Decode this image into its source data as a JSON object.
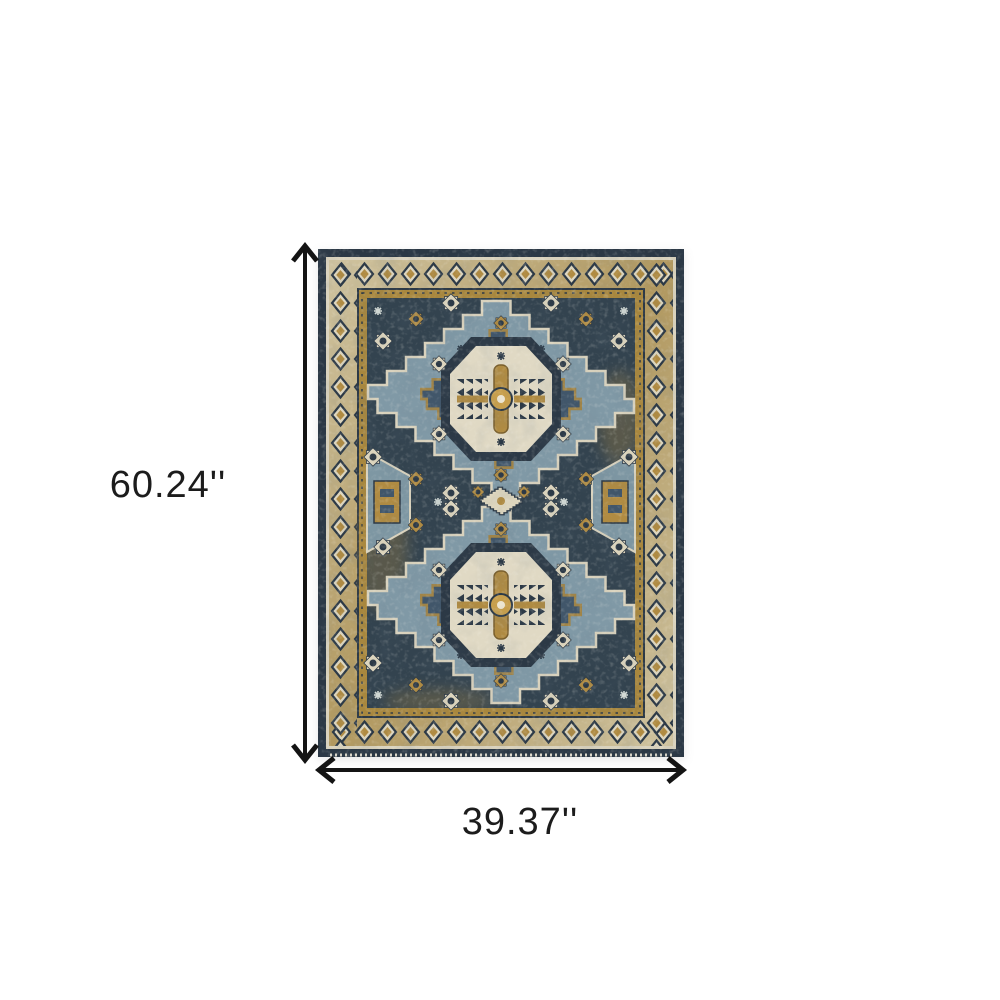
{
  "scene": {
    "description": "Product dimension image: top view of a rectangular distressed oriental area rug on a plain white background with black measurement arrows along its left side and bottom edge.",
    "background_color": "#ffffff"
  },
  "product": {
    "name": "Blue and gold distressed oriental area rug with two stacked stepped-diamond medallions, ivory octagon centers, star rosettes and a diamond-chain border"
  },
  "dimensions": {
    "height_label": "60.24''",
    "width_label": "39.37''",
    "height_value_inches": 60.24,
    "width_value_inches": 39.37,
    "unit": "inches"
  },
  "palette": {
    "pageBackground": "#ffffff",
    "arrowColor": "#141414",
    "labelColor": "#1c1c1c",
    "rugEdgeNavy": "#2b3845",
    "rugSelvageCream": "#d9d2bd",
    "rugBandGoldLight": "#cfc3a0",
    "rugBandGoldDeep": "#b1985f",
    "rugGuardGold": "#a8873e",
    "rugFieldNavy": "#33434f",
    "rugDiamondBlue": "#8099a6",
    "rugInnerNavy": "#41566a",
    "rugMedallionCream": "#e0d9c4",
    "rugRosetteCream": "#ddd5bd",
    "rugGold": "#b08b42",
    "rugOutlineNavy": "#2c3946"
  }
}
